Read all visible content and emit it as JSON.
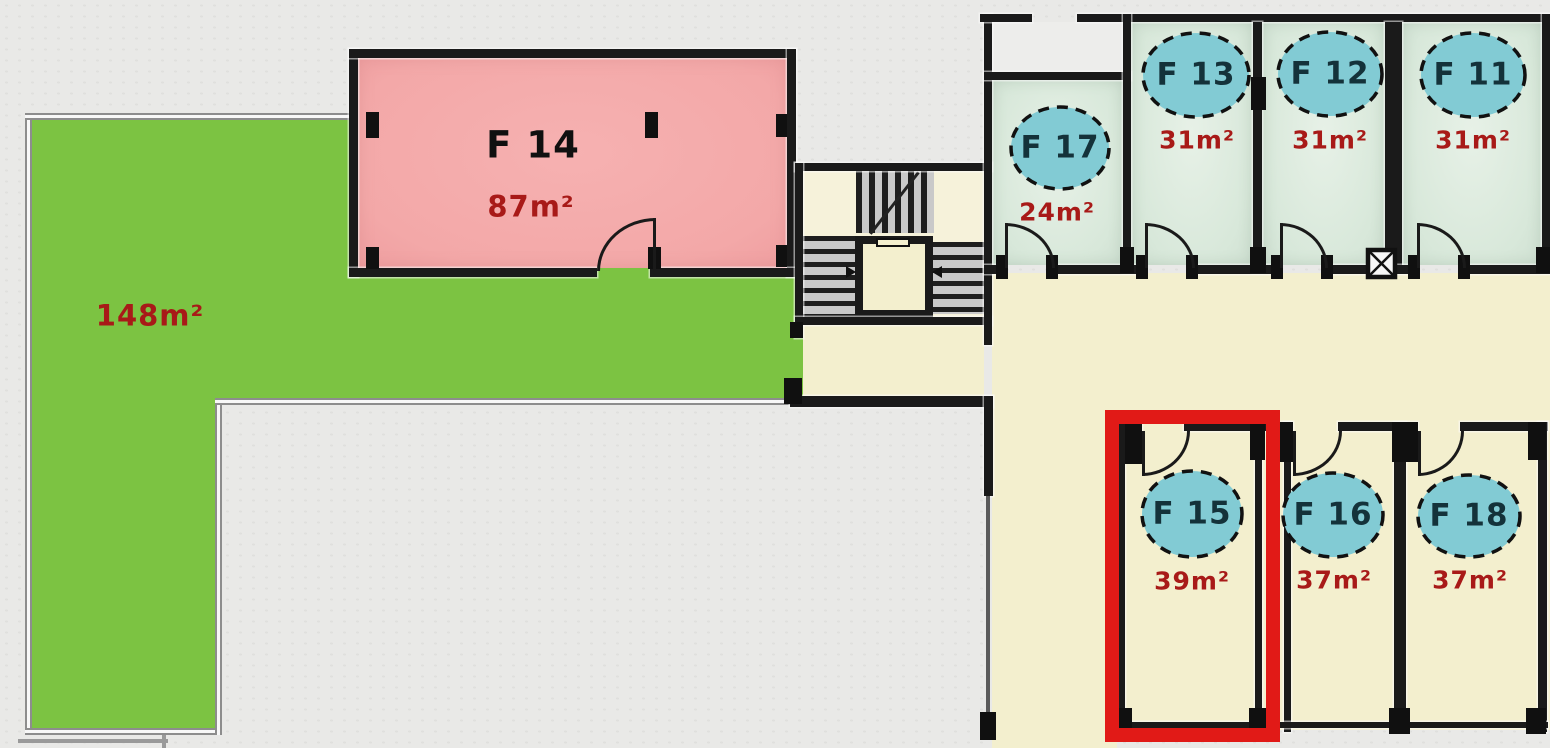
{
  "terrace": {
    "area": "148m²"
  },
  "units": {
    "f14": {
      "name": "F 14",
      "area": "87m²"
    },
    "f17": {
      "name": "F 17",
      "area": "24m²"
    },
    "f13": {
      "name": "F 13",
      "area": "31m²"
    },
    "f12": {
      "name": "F 12",
      "area": "31m²"
    },
    "f11": {
      "name": "F 11",
      "area": "31m²"
    },
    "f15": {
      "name": "F 15",
      "area": "39m²",
      "highlighted": true
    },
    "f16": {
      "name": "F 16",
      "area": "37m²"
    },
    "f18": {
      "name": "F 18",
      "area": "37m²"
    }
  },
  "colors": {
    "terrace_green": "#7cc342",
    "room_pink": "#f3a8a8",
    "room_mint": "#d8e8da",
    "floor_cream": "#f3efce",
    "badge_teal": "#82cbd4",
    "area_text_red": "#a81a18",
    "badge_text": "#14323a",
    "wall_black": "#1a1a1a",
    "highlight_red": "#e11a17"
  }
}
